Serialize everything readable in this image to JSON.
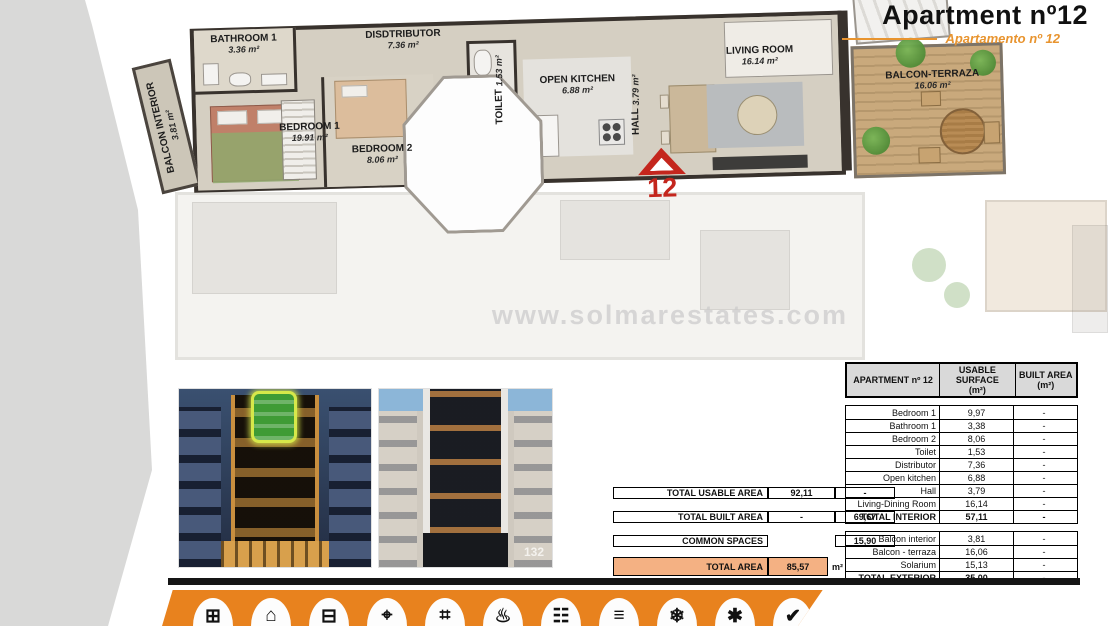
{
  "header": {
    "title": "Apartment nº12",
    "subtitle": "Apartamento nº 12"
  },
  "colors": {
    "accent_orange": "#e8821e",
    "subtitle_orange": "#e8942f",
    "total_row_orange": "#f4b183",
    "table_header_gray": "#d9d9d9",
    "marker_red": "#c4261d",
    "highlight_green": "#3f9b35"
  },
  "floor_plan": {
    "watermark": "www.solmarestates.com",
    "unit_marker": "12",
    "rooms": [
      {
        "id": "balcon-interior",
        "label": "BALCON INTERIOR",
        "area": "3.81 m²"
      },
      {
        "id": "bathroom-1",
        "label": "BATHROOM 1",
        "area": "3.36 m²"
      },
      {
        "id": "bedroom-1",
        "label": "BEDROOM 1",
        "area": "19.91 m²"
      },
      {
        "id": "distributor",
        "label": "DISDTRIBUTOR",
        "area": "7.36 m²"
      },
      {
        "id": "bedroom-2",
        "label": "BEDROOM 2",
        "area": "8.06 m²"
      },
      {
        "id": "toilet",
        "label": "TOILET",
        "area": "1.53 m²"
      },
      {
        "id": "open-kitchen",
        "label": "OPEN KITCHEN",
        "area": "6.88 m²"
      },
      {
        "id": "hall",
        "label": "HALL",
        "area": "3.79 m²"
      },
      {
        "id": "living-room",
        "label": "LIVING ROOM",
        "area": "16.14 m²"
      },
      {
        "id": "balcon-terraza",
        "label": "BALCON-TERRAZA",
        "area": "16.06 m²"
      }
    ]
  },
  "photos": {
    "building_number": "132"
  },
  "summary": {
    "rows": [
      {
        "label": "TOTAL USABLE AREA",
        "usable": "92,11",
        "built": "-"
      },
      {
        "label": "TOTAL BUILT AREA",
        "usable": "-",
        "built": "69,67"
      },
      {
        "label": "COMMON SPACES",
        "usable": "",
        "built": "15,90"
      }
    ],
    "total": {
      "label": "TOTAL AREA",
      "value": "85,57",
      "unit": "m²"
    }
  },
  "area_table": {
    "header": {
      "col1": "APARTMENT nº 12",
      "col2": "USABLE SURFACE",
      "col2_unit": "(m²)",
      "col3": "BUILT AREA",
      "col3_unit": "(m²)"
    },
    "interior_rows": [
      {
        "name": "Bedroom 1",
        "usable": "9,97",
        "built": "-"
      },
      {
        "name": "Bathroom 1",
        "usable": "3,38",
        "built": "-"
      },
      {
        "name": "Bedroom 2",
        "usable": "8,06",
        "built": "-"
      },
      {
        "name": "Toilet",
        "usable": "1,53",
        "built": "-"
      },
      {
        "name": "Distributor",
        "usable": "7,36",
        "built": "-"
      },
      {
        "name": "Open kitchen",
        "usable": "6,88",
        "built": "-"
      },
      {
        "name": "Hall",
        "usable": "3,79",
        "built": "-"
      },
      {
        "name": "Living-Dining Room",
        "usable": "16,14",
        "built": "-"
      },
      {
        "name": "TOTAL INTERIOR",
        "usable": "57,11",
        "built": "-"
      }
    ],
    "exterior_rows": [
      {
        "name": "Balcon interior",
        "usable": "3,81",
        "built": "-"
      },
      {
        "name": "Balcon - terraza",
        "usable": "16,06",
        "built": "-"
      },
      {
        "name": "Solarium",
        "usable": "15,13",
        "built": "-"
      },
      {
        "name": "TOTAL EXTERIOR",
        "usable": "35,00",
        "built": "-"
      }
    ]
  },
  "footer": {
    "icons": [
      {
        "name": "dimensions-icon",
        "glyph": "⊞"
      },
      {
        "name": "home-icon",
        "glyph": "⌂"
      },
      {
        "name": "bed-icon",
        "glyph": "⊟"
      },
      {
        "name": "lamp-icon",
        "glyph": "⌖"
      },
      {
        "name": "ladder-icon",
        "glyph": "⌗"
      },
      {
        "name": "heating-icon",
        "glyph": "♨"
      },
      {
        "name": "wardrobe-icon",
        "glyph": "☷"
      },
      {
        "name": "family-icon",
        "glyph": "≡"
      },
      {
        "name": "checklist-icon",
        "glyph": "❄"
      },
      {
        "name": "air-conditioning-icon",
        "glyph": "✱"
      },
      {
        "name": "warranty-icon",
        "glyph": "✔"
      }
    ]
  }
}
